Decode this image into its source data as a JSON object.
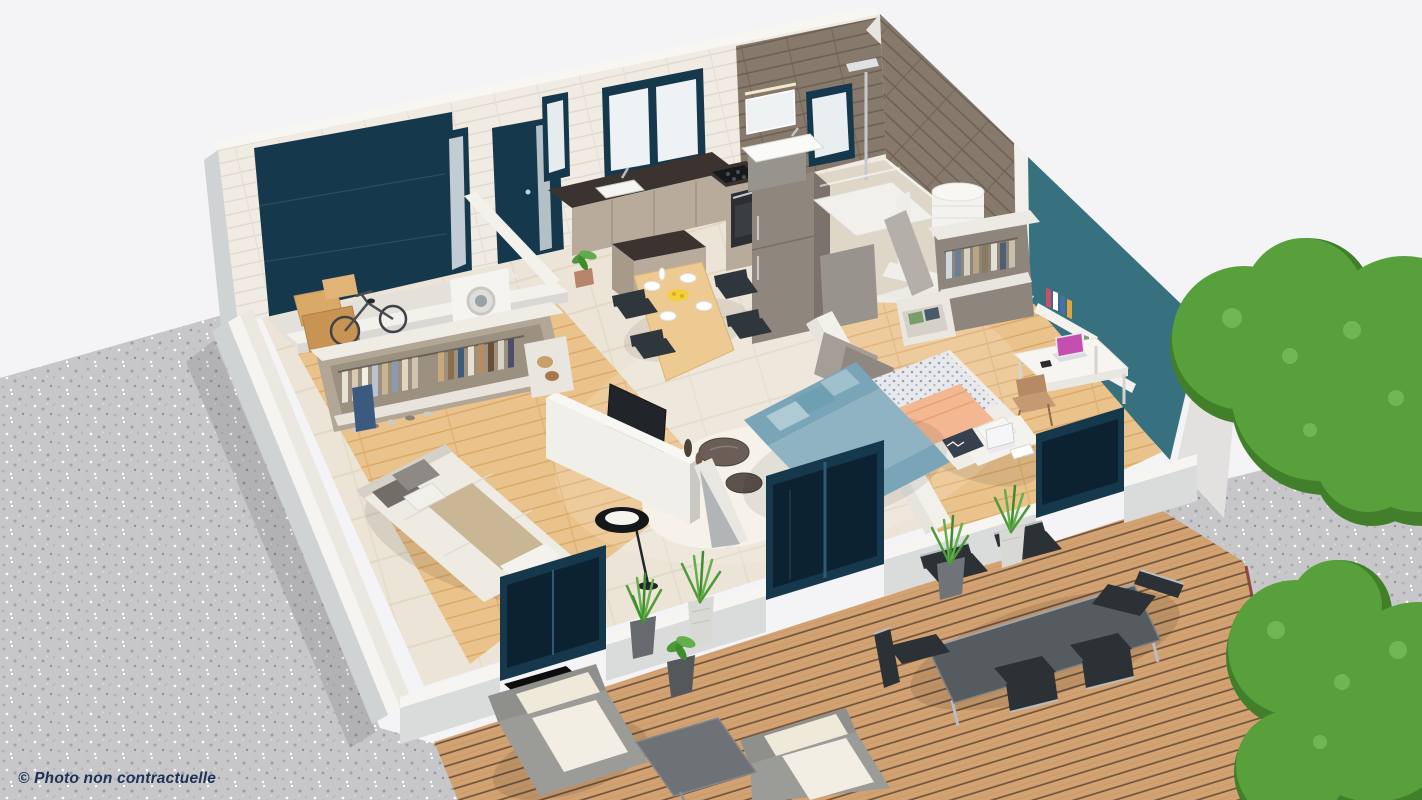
{
  "caption": {
    "text": "© Photo non contractuelle"
  },
  "palette": {
    "background": "#f4f4f6",
    "gravel": "#c7c7c9",
    "deck_wood": "#d3a272",
    "oak_floor": "#eac28c",
    "tile_floor": "#ece4d6",
    "concrete_floor": "#e3e1da",
    "brick_white": "#f0ebe3",
    "bath_tile": "#87796b",
    "wall_white": "#f2f0ea",
    "wall_gray": "#d0d3d4",
    "teal_accent_wall": "#37717f",
    "dark_teal_joinery": "#16384c",
    "glass_dark": "#0d2231",
    "counter_marble": "#3b3330",
    "cabinet_taupe": "#b9ab9c",
    "fridge_taupe": "#8f867e",
    "dining_wood": "#ecca92",
    "sofa_blue": "#8fb3c2",
    "sofa_blue_dark": "#7aa5b8",
    "peach_throw": "#f3b891",
    "rattan_gray": "#9b9b97",
    "cushion_cream": "#f2eee4",
    "outdoor_table": "#565b60",
    "outdoor_chair": "#2c3136",
    "bush_green": "#58a03c",
    "bush_green_dark": "#417f2a",
    "bush_highlight": "#79c15d",
    "caption_color": "#1d3058"
  },
  "scene": {
    "type": "isometric-3d-floor-plan-render",
    "rooms": [
      "garage",
      "entrance-hall",
      "kitchen-dining",
      "bathroom",
      "living-room",
      "bedroom-1",
      "bedroom-2"
    ],
    "exterior": [
      "gravel-ground",
      "wood-deck-terrace",
      "garden-bushes"
    ],
    "key_objects": [
      "garage-door",
      "entry-door",
      "washing-machine",
      "bicycle",
      "kitchen-counter",
      "fridge",
      "kitchen-island",
      "dining-table",
      "shower",
      "vanity-sink",
      "water-heater",
      "wardrobes",
      "beds",
      "sofa",
      "tv",
      "desk",
      "floor-lamp",
      "outdoor-dining-set",
      "lounge-armchairs",
      "planters"
    ]
  }
}
